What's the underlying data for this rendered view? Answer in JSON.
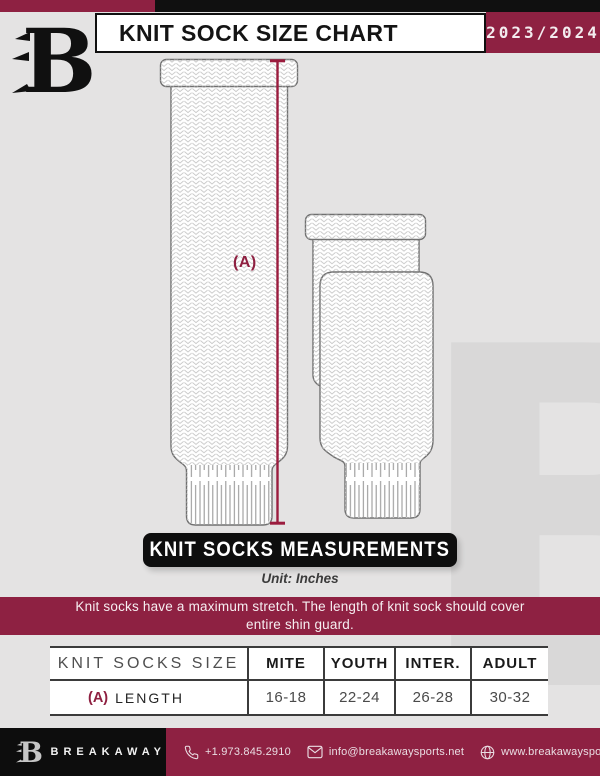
{
  "header": {
    "title": "KNIT SOCK SIZE CHART",
    "season": "2023/2024"
  },
  "diagram": {
    "length_label": "(A)"
  },
  "sections": {
    "measurements_banner": "KNIT SOCKS MEASUREMENTS",
    "unit_note": "Unit: Inches",
    "stretch_note_line1": "Knit socks have a maximum stretch. The length of knit sock should cover",
    "stretch_note_line2": "entire shin guard."
  },
  "table": {
    "title": "KNIT SOCKS SIZE",
    "columns": [
      "MITE",
      "YOUTH",
      "INTER.",
      "ADULT"
    ],
    "rows": [
      {
        "label_prefix": "(A)",
        "label": "LENGTH",
        "values": [
          "16-18",
          "22-24",
          "26-28",
          "30-32"
        ]
      }
    ]
  },
  "footer": {
    "brand": "BREAKAWAY",
    "phone": "+1.973.845.2910",
    "email": "info@breakawaysports.net",
    "website": "www.breakawaysports.net"
  },
  "branding": {
    "watermark_letter": "B"
  },
  "colors": {
    "maroon": "#8e2142",
    "black": "#101010",
    "page_background": "#e4e3e3",
    "measure_line": "#9b1c3e"
  }
}
